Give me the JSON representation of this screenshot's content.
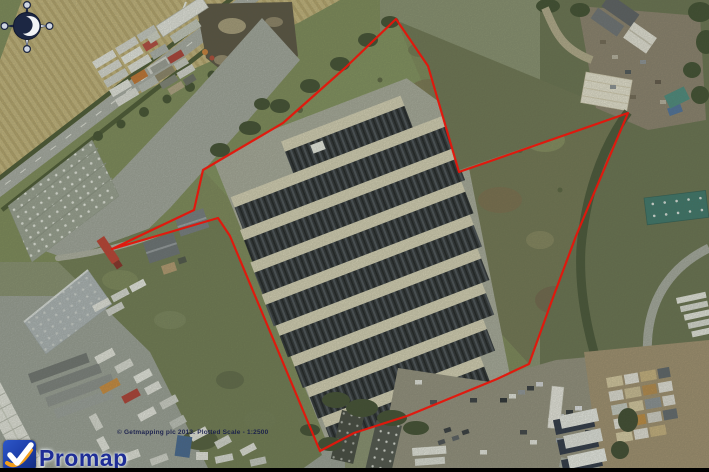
{
  "canvas": {
    "width": 709,
    "height": 472
  },
  "map": {
    "type": "aerial-photograph",
    "copyright_line": "© Getmapping plc 2013. Plotted Scale - 1:2500"
  },
  "overlay": {
    "boundary_color": "#e5150b",
    "boundary_points": "396,19 428,66 459,172 628,113 589,205 576,236 551,303 529,364 497,379 407,416 354,433 320,451 230,236 218,218 112,249 194,210 203,170 283,123 345,68"
  },
  "branding": {
    "logo_text": "Promap",
    "tile_color_top": "#2d57c8",
    "tile_color_bottom": "#142c7a",
    "check_color": "#ffffff",
    "swoosh_color": "#f29e1c",
    "text_color": "#1f2d96"
  },
  "compass": {
    "icon": "north-compass-rose"
  }
}
